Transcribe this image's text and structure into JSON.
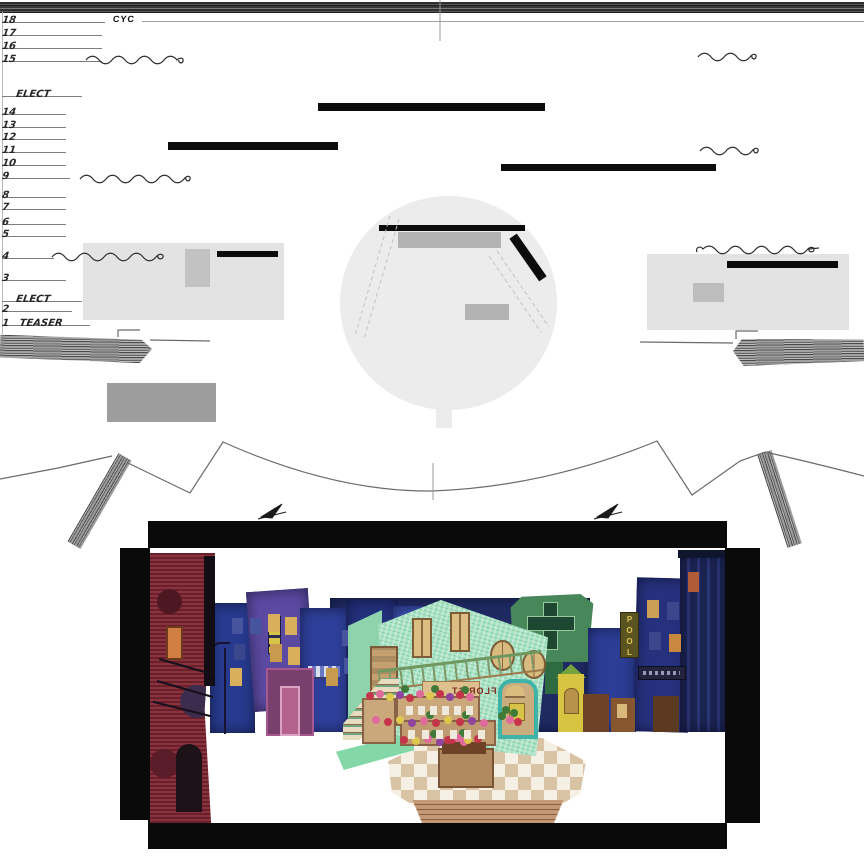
{
  "groundplan": {
    "cyc_label": "CYC",
    "linesets": [
      "18",
      "17",
      "16",
      "15",
      "ELECT",
      "14",
      "13",
      "12",
      "11",
      "10",
      "9",
      "8",
      "7",
      "6",
      "5",
      "4",
      "3",
      "ELECT",
      "2",
      "1   TEASER"
    ]
  },
  "rendering": {
    "florist_sign": "FLORIST",
    "pool_sign": "POOL"
  },
  "colors": {
    "plan_panel_gray": "#e3e3e3",
    "plan_bar_black": "#0c0c0c",
    "board_black": "#0a0a0a",
    "florist_mint": "#a9e3c3",
    "city_blue": "#2c3a8c",
    "brick_red": "#822633"
  }
}
